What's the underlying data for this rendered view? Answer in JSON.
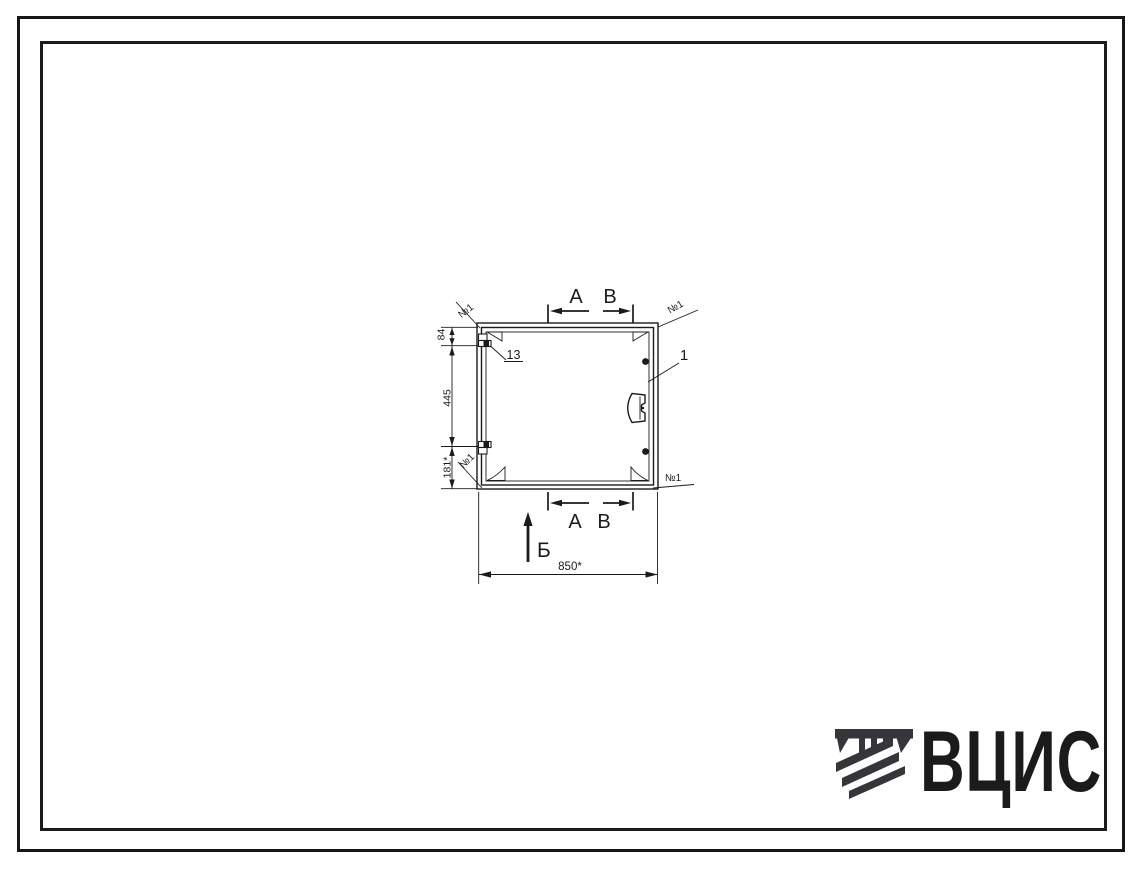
{
  "page": {
    "background": "#ffffff",
    "frame_color": "#1a1a1a",
    "ink_color": "#1b1b1b"
  },
  "drawing": {
    "section_marks": {
      "a": "А",
      "b": "В"
    },
    "view_mark": "Б",
    "callouts": {
      "door_leaf": "1",
      "hinge": "13"
    },
    "weld_marks": [
      "№1",
      "№1",
      "№1",
      "№1"
    ],
    "dimensions": {
      "overall_width": "850*",
      "top_hinge_offset": "84",
      "hinge_spacing": "445",
      "bottom_offset": "181*"
    }
  },
  "logo": {
    "text": "ВЦИС",
    "color": "#35353a"
  }
}
